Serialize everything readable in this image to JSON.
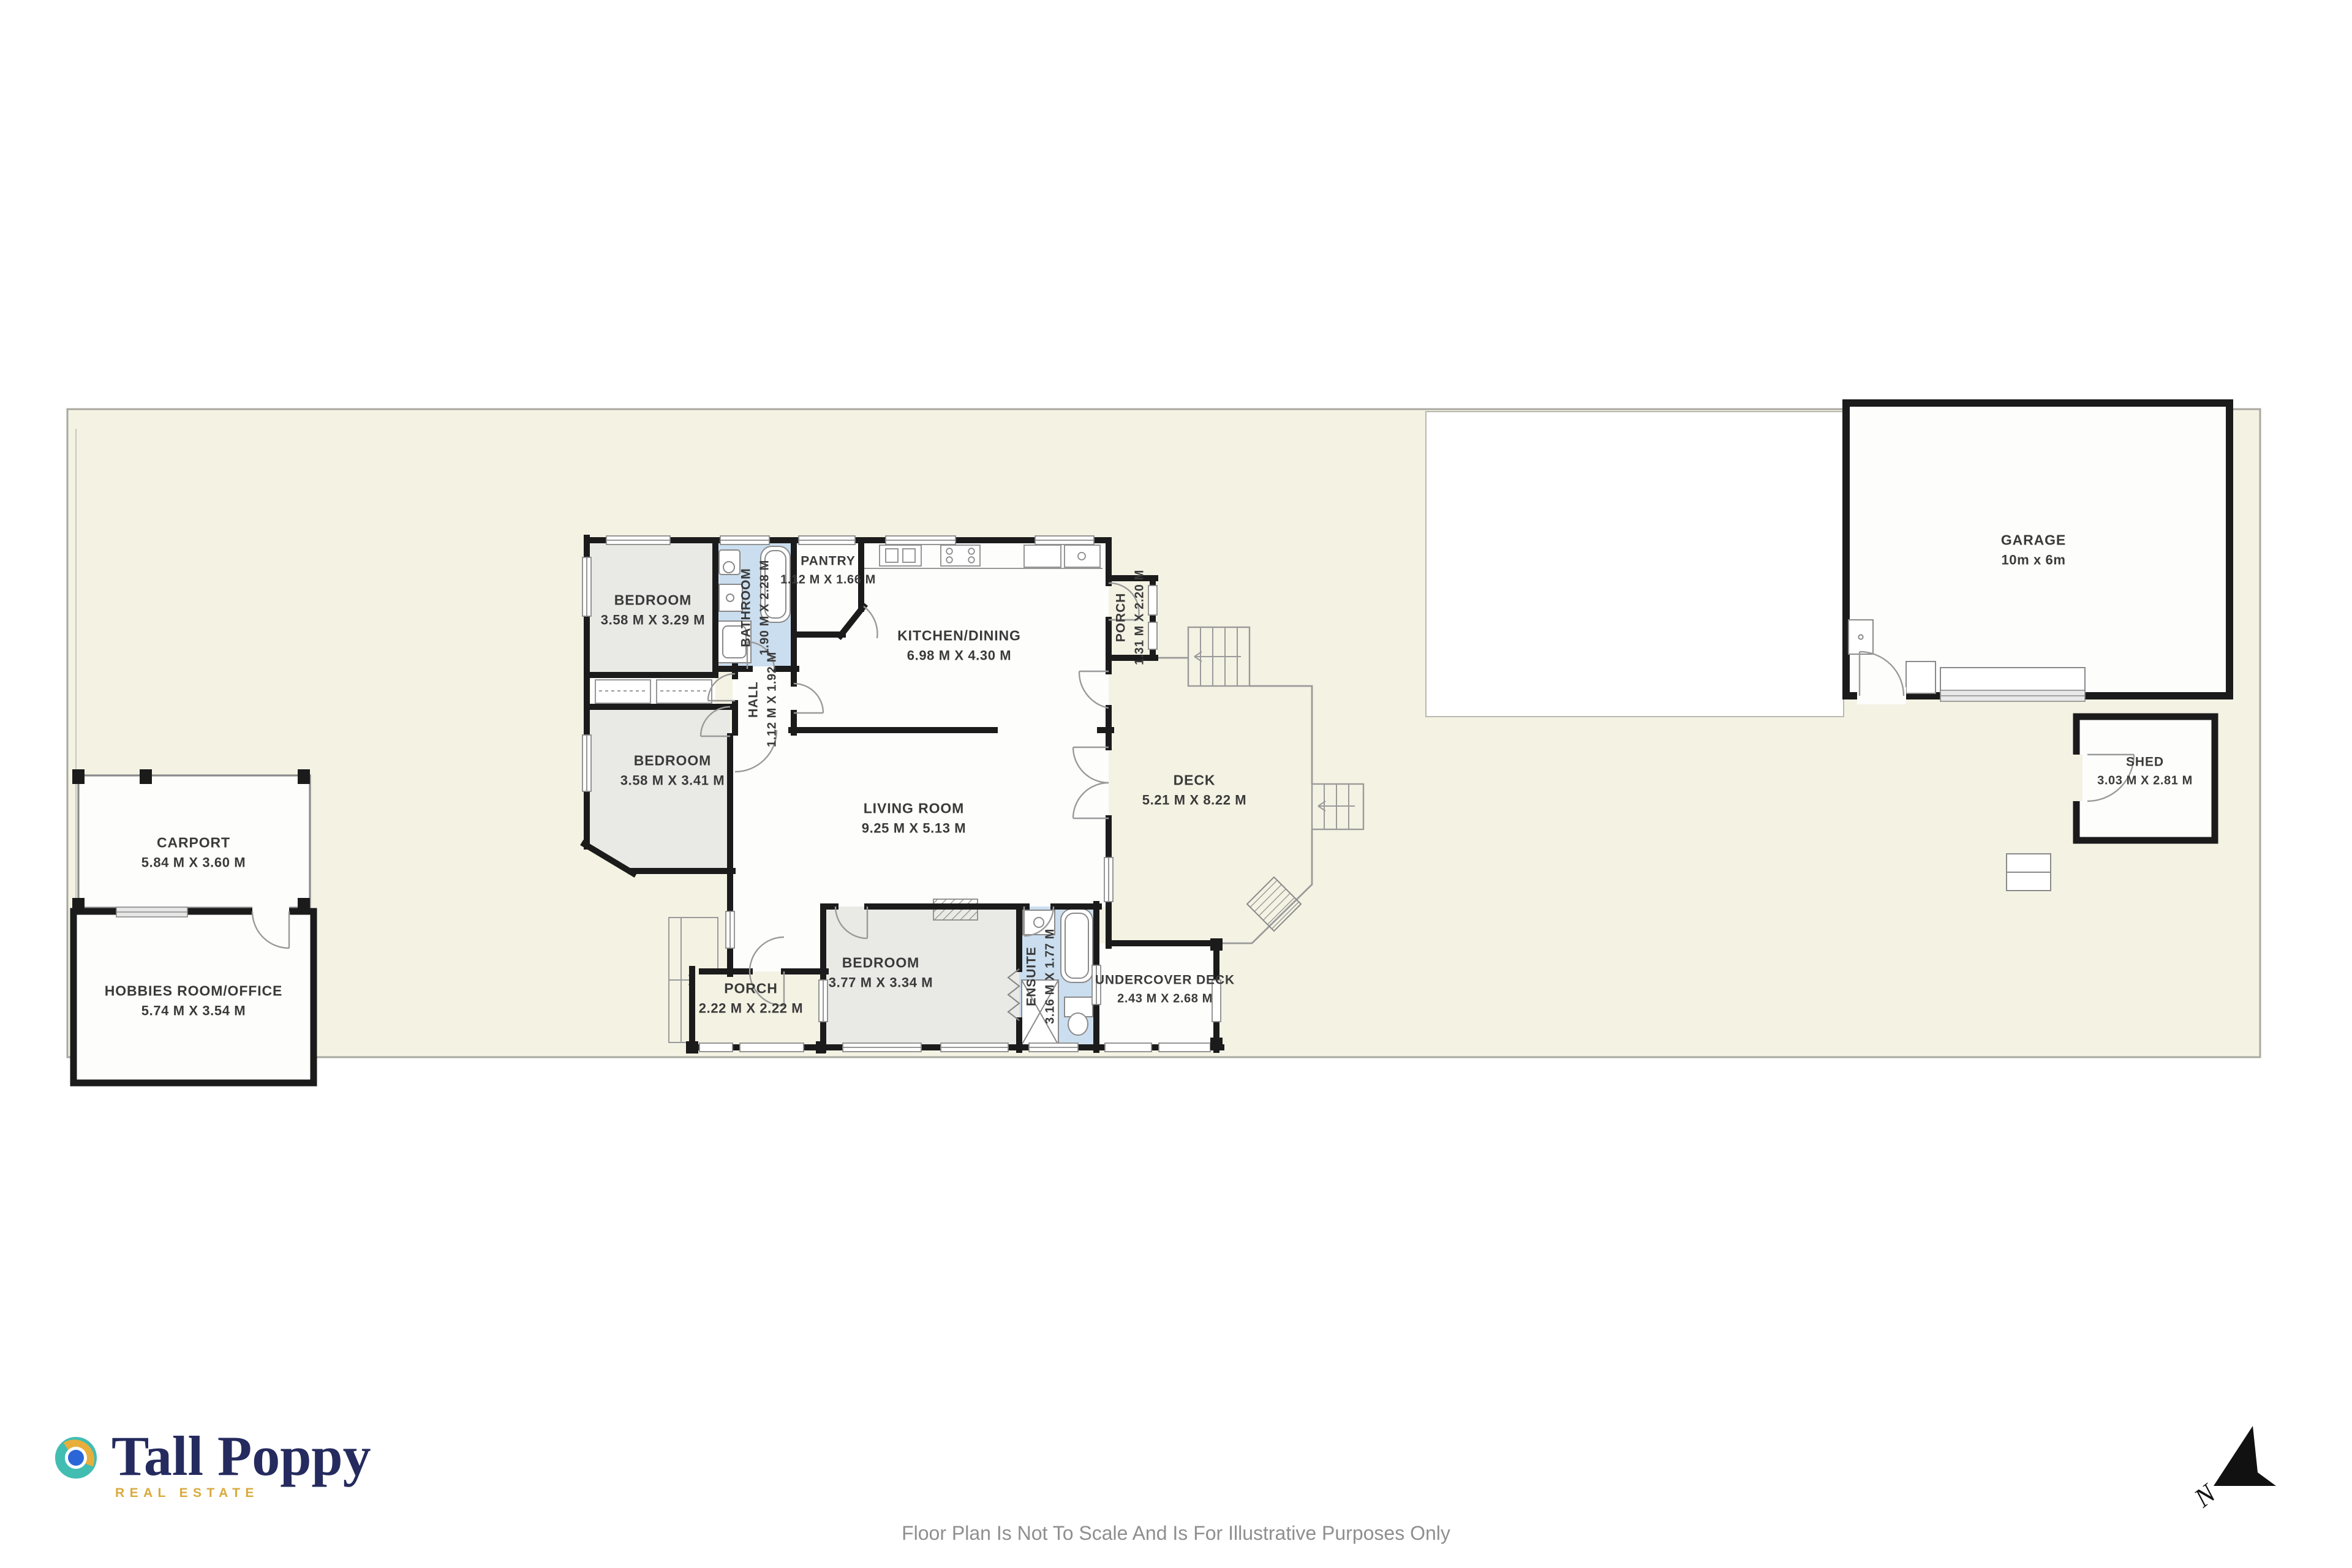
{
  "rooms": {
    "bedroom1": {
      "name": "BEDROOM",
      "dims": "3.58 M X 3.29 M"
    },
    "bathroom": {
      "name": "BATHROOM",
      "dims": "1.90 M X 2.28 M"
    },
    "pantry": {
      "name": "PANTRY",
      "dims": "1.12 M X 1.66 M"
    },
    "kitchen": {
      "name": "KITCHEN/DINING",
      "dims": "6.98 M X 4.30 M"
    },
    "porch_right": {
      "name": "PORCH",
      "dims": "1.31 M X 2.20 M"
    },
    "hall": {
      "name": "HALL",
      "dims": "1.12 M X 1.92 M"
    },
    "bedroom2": {
      "name": "BEDROOM",
      "dims": "3.58 M X 3.41 M"
    },
    "living": {
      "name": "LIVING ROOM",
      "dims": "9.25 M X 5.13 M"
    },
    "deck": {
      "name": "DECK",
      "dims": "5.21 M X 8.22 M"
    },
    "porch_bottom": {
      "name": "PORCH",
      "dims": "2.22 M X 2.22 M"
    },
    "bedroom3": {
      "name": "BEDROOM",
      "dims": "3.77 M X 3.34 M"
    },
    "ensuite": {
      "name": "ENSUITE",
      "dims": "3.16 M X 1.77 M"
    },
    "undercover_deck": {
      "name": "UNDERCOVER DECK",
      "dims": "2.43 M X 2.68 M"
    },
    "garage": {
      "name": "GARAGE",
      "dims": "10m x 6m"
    },
    "shed": {
      "name": "SHED",
      "dims": "3.03 M X 2.81 M"
    },
    "carport": {
      "name": "CARPORT",
      "dims": "5.84 M X 3.60 M"
    },
    "hobbies": {
      "name": "HOBBIES ROOM/OFFICE",
      "dims": "5.74 M X 3.54 M"
    }
  },
  "branding": {
    "brand": "Tall Poppy",
    "tagline": "REAL ESTATE",
    "brand_color": "#252b5e",
    "tagline_color": "#d9a93c",
    "icon_teal": "#41bdb2",
    "icon_gold": "#e8ae3b",
    "icon_blue": "#2b66d9"
  },
  "footer": {
    "disclaimer": "Floor Plan Is Not To Scale And Is For Illustrative Purposes Only"
  },
  "compass": {
    "label": "N"
  },
  "colors": {
    "yard": "#f4f2e3",
    "room_gray": "#e9e9e6",
    "wet_blue": "#cadeef",
    "wall": "#1b1b1b",
    "boundary": "#a9a8a0",
    "label_text": "#3a3a3a"
  }
}
